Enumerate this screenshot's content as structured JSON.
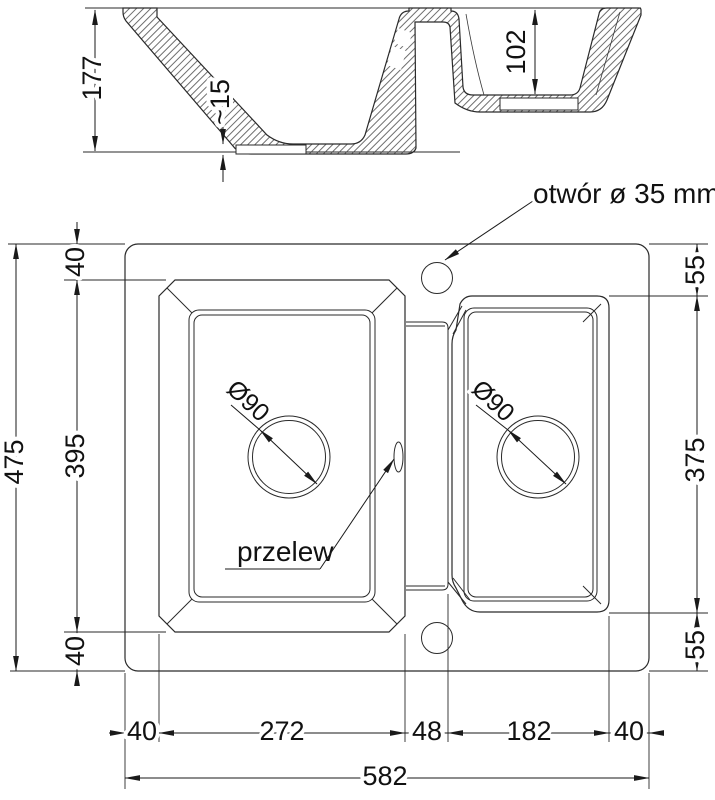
{
  "section": {
    "overall_height": "177",
    "bowl2_depth": "102",
    "bottom_thickness": "~15"
  },
  "plan": {
    "hole_label": "otwór ø 35 mm",
    "overflow_label": "przelew",
    "drain_left": "Ø90",
    "drain_right": "Ø90",
    "left_col": {
      "top": "40",
      "middle": "395",
      "bottom": "40",
      "overall": "475"
    },
    "right_col": {
      "top": "55",
      "middle": "375",
      "bottom": "55"
    },
    "bottom_row": {
      "m1": "40",
      "m2": "272",
      "m3": "48",
      "m4": "182",
      "m5": "40",
      "overall": "582"
    }
  },
  "colors": {
    "line": "#2a2a2a",
    "text": "#111111",
    "background": "#ffffff"
  }
}
